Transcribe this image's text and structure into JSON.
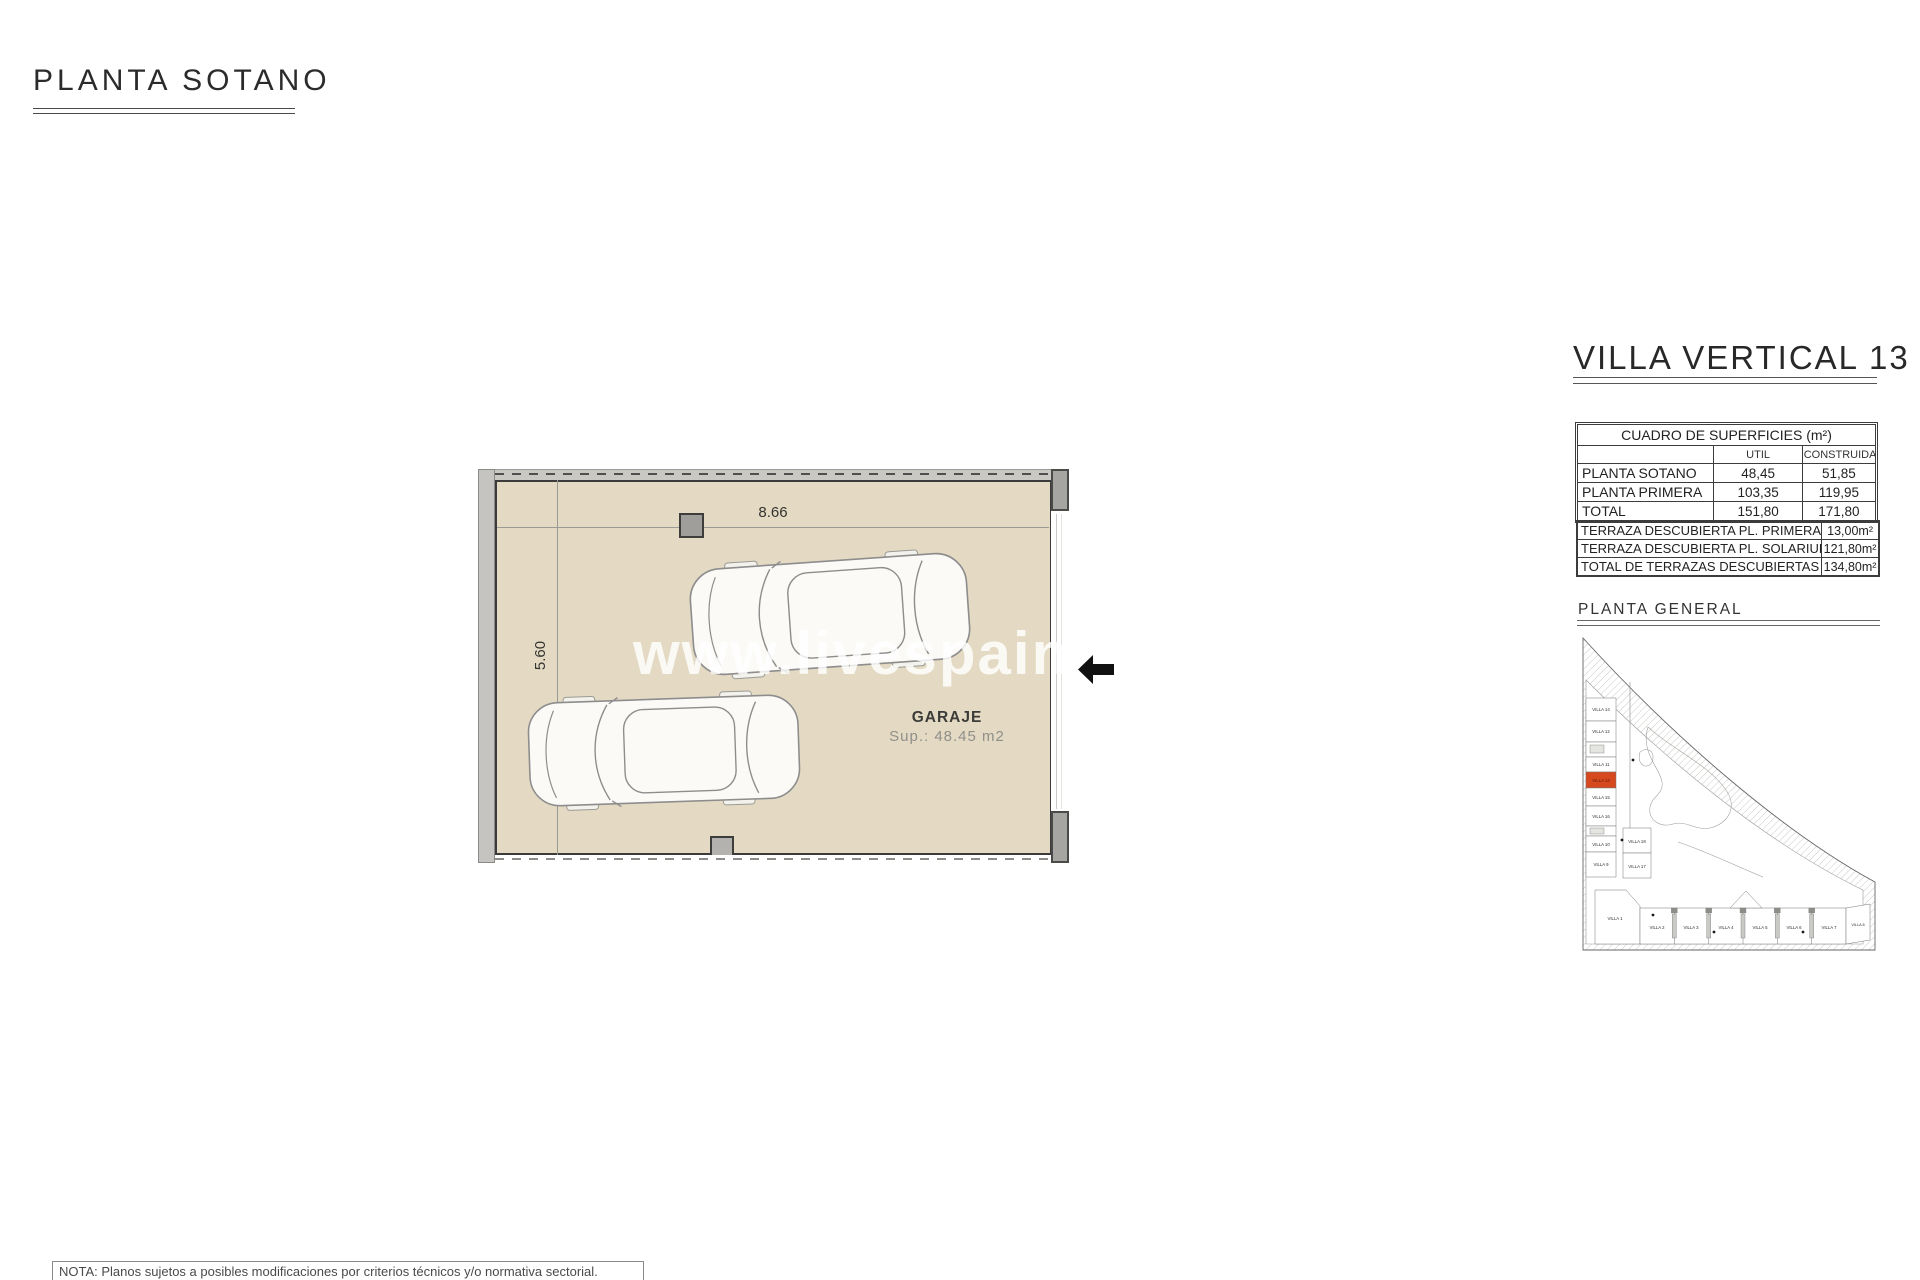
{
  "page": {
    "title": "PLANTA SOTANO",
    "note": "NOTA: Planos sujetos a posibles modificaciones por criterios técnicos y/o normativa sectorial."
  },
  "plan": {
    "watermark": "www.livespainfor",
    "room_label": "GARAJE",
    "room_area": "Sup.: 48.45 m2",
    "dim_width": "8.66",
    "dim_height": "5.60",
    "floor_color": "#e4dac4"
  },
  "sidebar": {
    "title": "VILLA VERTICAL 13",
    "surfaces_table": {
      "title": "CUADRO DE SUPERFICIES (m²)",
      "col_util": "UTIL",
      "col_construida": "CONSTRUIDA",
      "rows": [
        {
          "label": "PLANTA SOTANO",
          "util": "48,45",
          "construida": "51,85"
        },
        {
          "label": "PLANTA PRIMERA",
          "util": "103,35",
          "construida": "119,95"
        },
        {
          "label": "TOTAL",
          "util": "151,80",
          "construida": "171,80"
        }
      ]
    },
    "terraces_table": {
      "rows": [
        {
          "label": "TERRAZA DESCUBIERTA PL. PRIMERA",
          "value": "13,00m²"
        },
        {
          "label": "TERRAZA DESCUBIERTA PL. SOLARIUM",
          "value": "121,80m²"
        },
        {
          "label": "TOTAL DE TERRAZAS DESCUBIERTAS",
          "value": "134,80m²"
        }
      ]
    },
    "site_plan": {
      "label": "PLANTA GENERAL",
      "highlighted_villa": "VILLA 13",
      "highlight_color": "#d6481e",
      "left_villas": [
        "VILLA 14",
        "VILLA 12",
        "VILLA 11",
        "VILLA 13",
        "VILLA 15",
        "VILLA 16",
        "VILLA 10",
        "VILLA 9"
      ],
      "middle_villas": [
        "VILLA 18",
        "VILLA 17"
      ],
      "bottom_villas": [
        "VILLA 1",
        "VILLA 2",
        "VILLA 3",
        "VILLA 4",
        "VILLA 5",
        "VILLA 6",
        "VILLA 7",
        "VILLA 8"
      ]
    }
  }
}
